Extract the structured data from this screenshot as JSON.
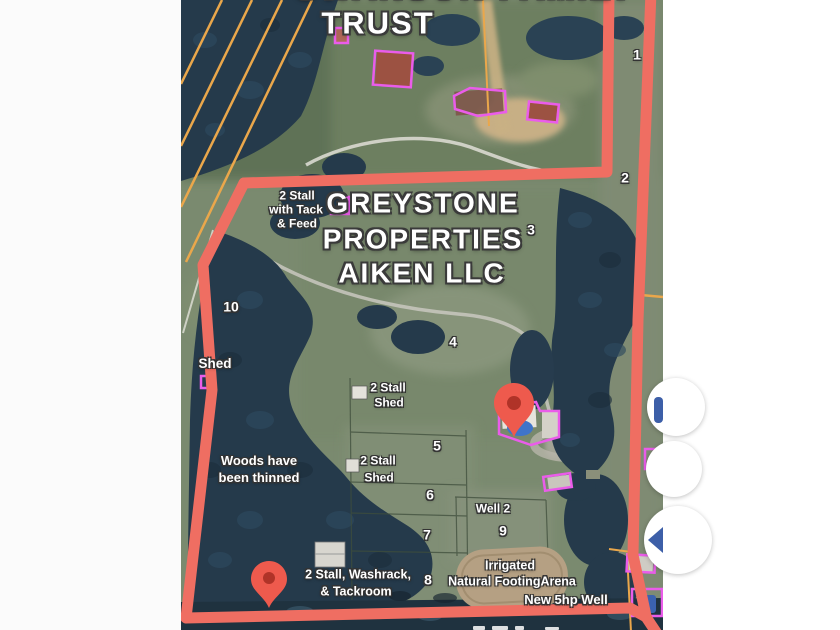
{
  "frame": {
    "background": "#ffffff"
  },
  "map": {
    "titles": {
      "top_partial": "SWANSON FAMILY",
      "trust": "TRUST",
      "property1": "GREYSTONE",
      "property2": "PROPERTIES",
      "property3": "AIKEN LLC"
    },
    "numbers": {
      "n1": "1",
      "n2": "2",
      "n3": "3",
      "n4": "4",
      "n5": "5",
      "n6": "6",
      "n7": "7",
      "n8": "8",
      "n9": "9",
      "n10": "10"
    },
    "annotations": {
      "stall_tack_1": "2 Stall",
      "stall_tack_2": "with Tack",
      "stall_tack_3": "& Feed",
      "shed": "Shed",
      "stall_shed_a1": "2 Stall",
      "stall_shed_a2": "Shed",
      "stall_shed_b1": "2 Stall",
      "stall_shed_b2": "Shed",
      "woods_1": "Woods have",
      "woods_2": "been thinned",
      "well2": "Well 2",
      "arena_1": "Irrigated",
      "arena_2": "Natural FootingArena",
      "new_well": "New 5hp Well",
      "washrack_1": "2 Stall, Washrack,",
      "washrack_2": "& Tackroom"
    },
    "colors": {
      "boundary": "#ef6e62",
      "building_outline": "#ea5cea",
      "power_line": "#eaa74b",
      "pin": "#ee5a4d",
      "button_icon": "#3d5fa8"
    }
  }
}
